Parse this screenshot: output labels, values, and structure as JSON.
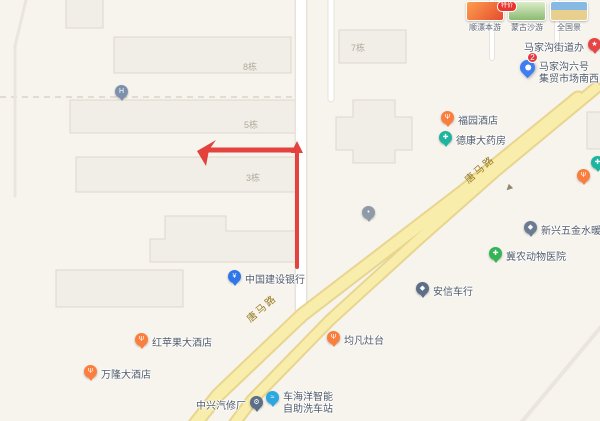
{
  "colors": {
    "background": "#f7f4ee",
    "building_fill": "#f1eee7",
    "building_stroke": "#ddd8cc",
    "road_fill": "#f8edaa",
    "road_casing": "#e8d58f",
    "minor_road": "#ffffff",
    "boundary_dash": "#d8d3c8",
    "annotation_red": "#e23530",
    "marker_blue": "#3f7df2",
    "badge_red": "#e6393b"
  },
  "roads": {
    "primary_name": "唐马路",
    "oneway_glyph": "▶"
  },
  "buildings": [
    {
      "label": "8栋"
    },
    {
      "label": "5栋"
    },
    {
      "label": "3栋"
    },
    {
      "label": "7栋"
    }
  ],
  "marker": {
    "badge": "2",
    "lines": [
      "马家沟六号",
      "集贸市场南西门"
    ]
  },
  "pois": [
    {
      "name": "马家沟街道办",
      "glyph": "★",
      "color": "#e64545"
    },
    {
      "name": "福园酒店",
      "glyph": "Ψ",
      "color": "#fb7e3c"
    },
    {
      "name": "德康大药房",
      "glyph": "✚",
      "color": "#1cb5a0"
    },
    {
      "name": "中国建设银行",
      "glyph": "¥",
      "color": "#2f77e8"
    },
    {
      "name": "红苹果大酒店",
      "glyph": "Ψ",
      "color": "#fb7e3c"
    },
    {
      "name": "万隆大酒店",
      "glyph": "Ψ",
      "color": "#fb7e3c"
    },
    {
      "name": "中兴汽修厂",
      "glyph": "⚙",
      "color": "#5d6f86"
    },
    {
      "name": "车海洋智能自助洗车站",
      "lines": [
        "车海洋智能",
        "自助洗车站"
      ],
      "glyph": "≈",
      "color": "#2ba8e0"
    },
    {
      "name": "均凡灶台",
      "glyph": "Ψ",
      "color": "#fb7e3c"
    },
    {
      "name": "安信车行",
      "glyph": "◆",
      "color": "#5d6f86"
    },
    {
      "name": "冀农动物医院",
      "glyph": "✚",
      "color": "#33b457"
    },
    {
      "name": "新兴五金水暖建材",
      "glyph": "◆",
      "color": "#6b7b92"
    },
    {
      "glyph": "H",
      "color": "#7d91ad"
    },
    {
      "glyph": "•",
      "color": "#8e9aa8"
    },
    {
      "glyph": "Ψ",
      "color": "#fb7e3c"
    },
    {
      "glyph": "✚",
      "color": "#1cb5a0"
    }
  ],
  "travel_cards": [
    {
      "caption": "顺漂本游",
      "badge": "特价"
    },
    {
      "caption": "蒙古沙游"
    },
    {
      "caption": "全国景"
    }
  ]
}
